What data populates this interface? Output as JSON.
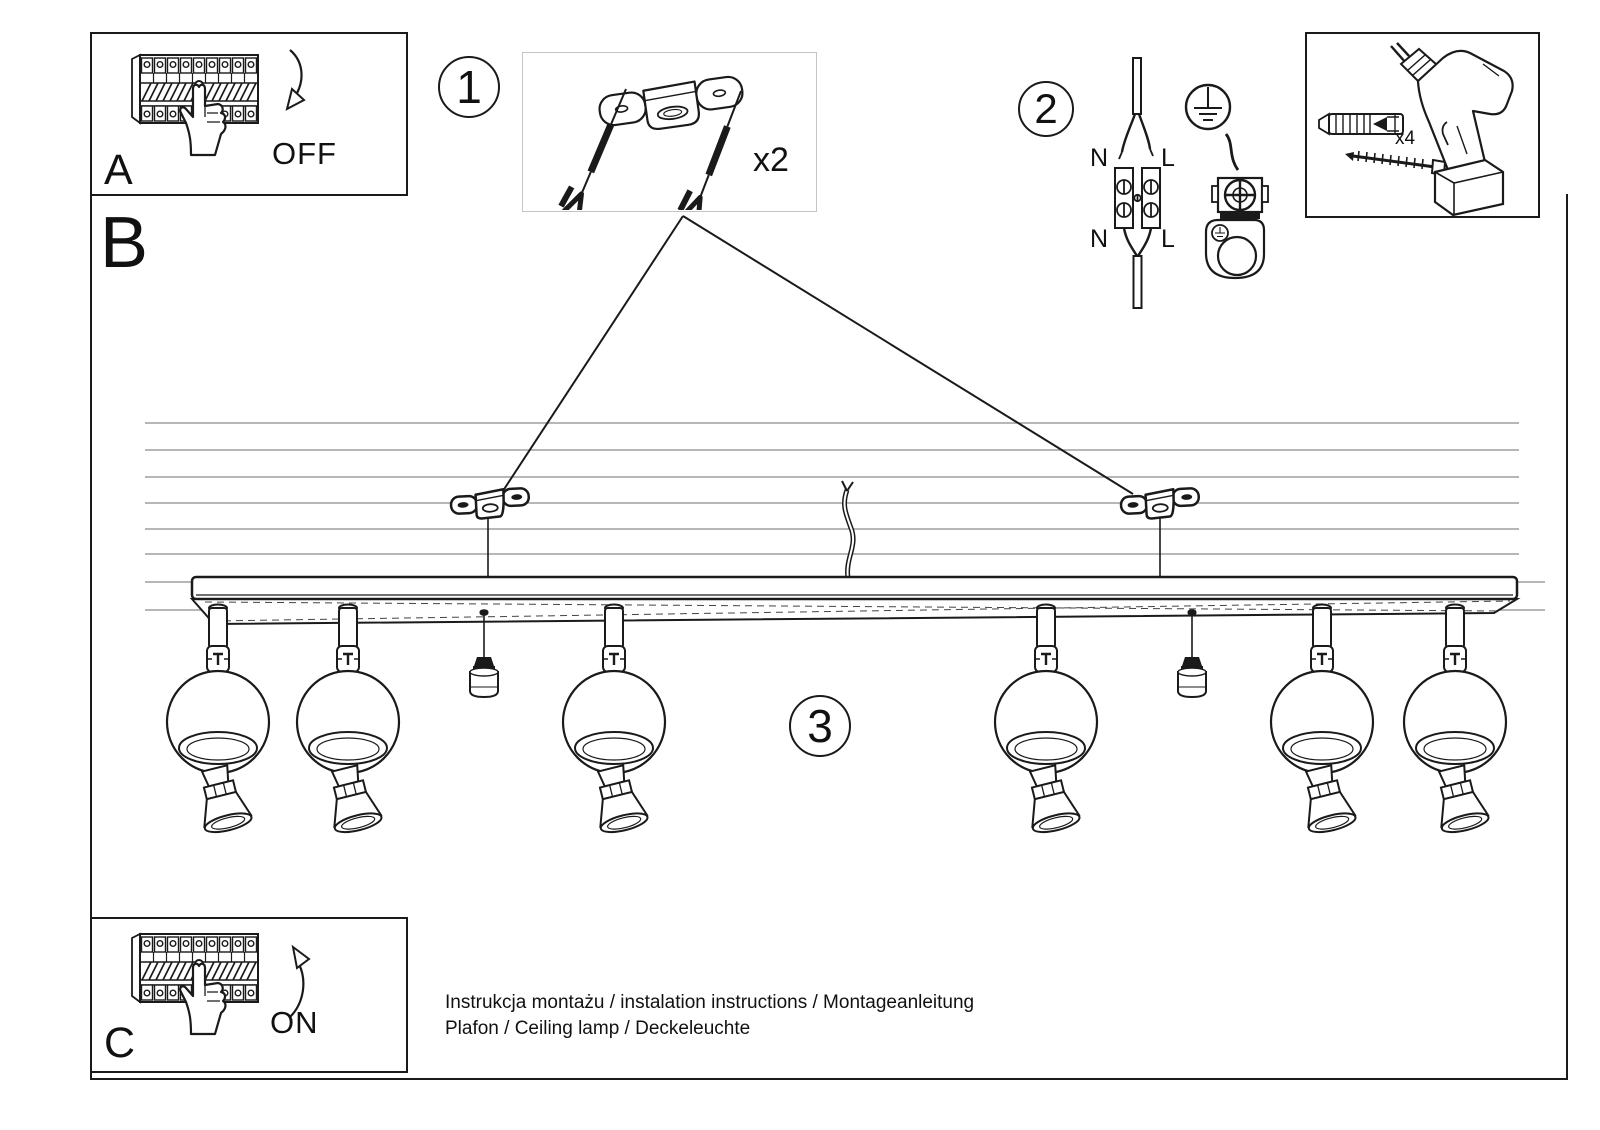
{
  "colors": {
    "ink": "#1a1a1a",
    "ceiling_line": "#8c8c8c",
    "step_box_border": "#c4c4c4"
  },
  "panel_a": {
    "letter": "A",
    "switch_label": "OFF"
  },
  "panel_c": {
    "letter": "C",
    "switch_label": "ON"
  },
  "section_label": "B",
  "step1": {
    "number": "1",
    "quantity_label": "x2"
  },
  "step2": {
    "number": "2",
    "labels": {
      "n_top": "N",
      "l_top": "L",
      "n_bottom": "N",
      "l_bottom": "L"
    }
  },
  "step3": {
    "number": "3"
  },
  "tools": {
    "dowel_quantity_label": "x4"
  },
  "footer": {
    "line1": "Instrukcja montażu / instalation instructions / Montageanleitung",
    "line2": "Plafon / Ceiling lamp / Deckeleuchte"
  }
}
